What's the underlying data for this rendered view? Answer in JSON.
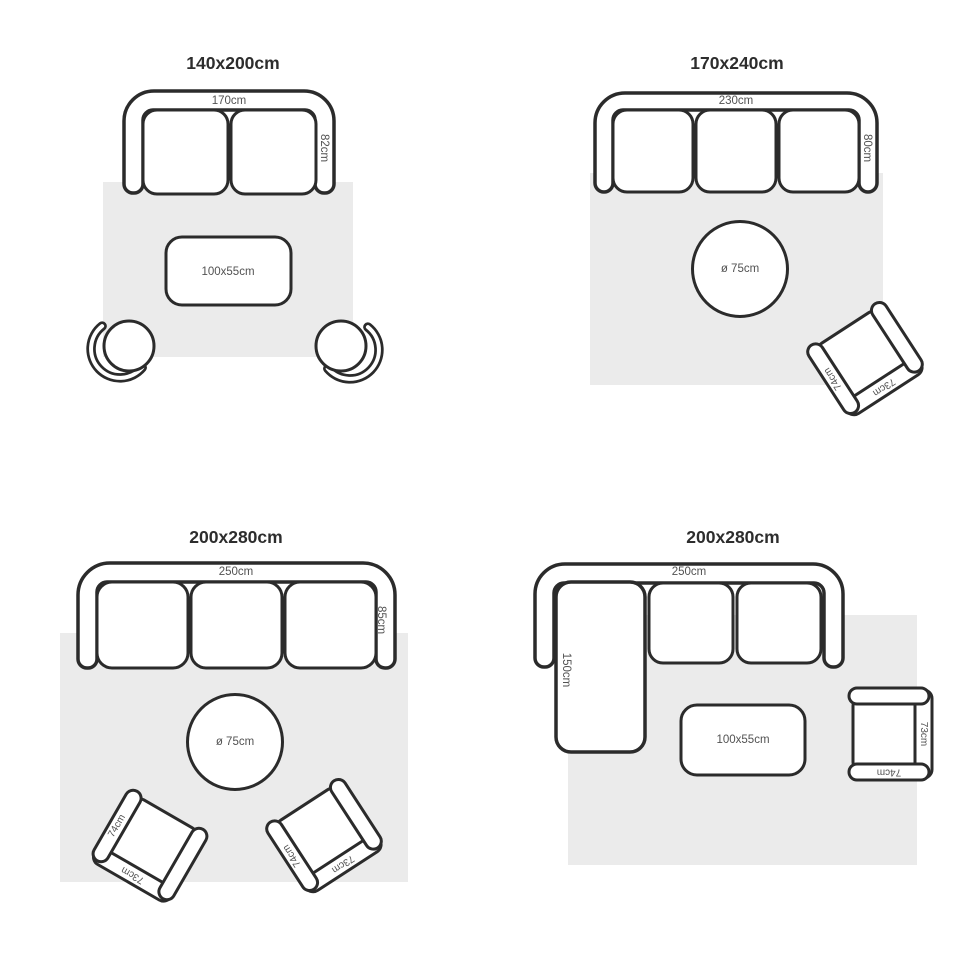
{
  "colors": {
    "line": "#2b2b2b",
    "rug": "#ebebeb",
    "label": "#525252",
    "title": "#2d2d2d"
  },
  "layouts": [
    {
      "title": "140x200cm",
      "sofa": {
        "type": "2-seater",
        "width": "170cm",
        "depth": "82cm"
      },
      "table": {
        "shape": "rectangle",
        "size": "100x55cm"
      },
      "chairs": [
        {
          "type": "round-chair"
        },
        {
          "type": "round-chair"
        }
      ]
    },
    {
      "title": "170x240cm",
      "sofa": {
        "type": "3-seater",
        "width": "230cm",
        "depth": "80cm"
      },
      "table": {
        "shape": "round",
        "size": "ø 75cm"
      },
      "chairs": [
        {
          "type": "armchair",
          "depth": "74cm",
          "width": "73cm"
        }
      ]
    },
    {
      "title": "200x280cm",
      "sofa": {
        "type": "3-seater",
        "width": "250cm",
        "depth": "85cm"
      },
      "table": {
        "shape": "round",
        "size": "ø 75cm"
      },
      "chairs": [
        {
          "type": "armchair",
          "depth": "74cm",
          "width": "73cm"
        },
        {
          "type": "armchair",
          "depth": "74cm",
          "width": "73cm"
        }
      ]
    },
    {
      "title": "200x280cm",
      "sofa": {
        "type": "corner-sectional",
        "width": "250cm",
        "chaise_depth": "150cm"
      },
      "table": {
        "shape": "rectangle",
        "size": "100x55cm"
      },
      "chairs": [
        {
          "type": "armchair",
          "depth": "74cm",
          "width": "73cm"
        }
      ]
    }
  ]
}
